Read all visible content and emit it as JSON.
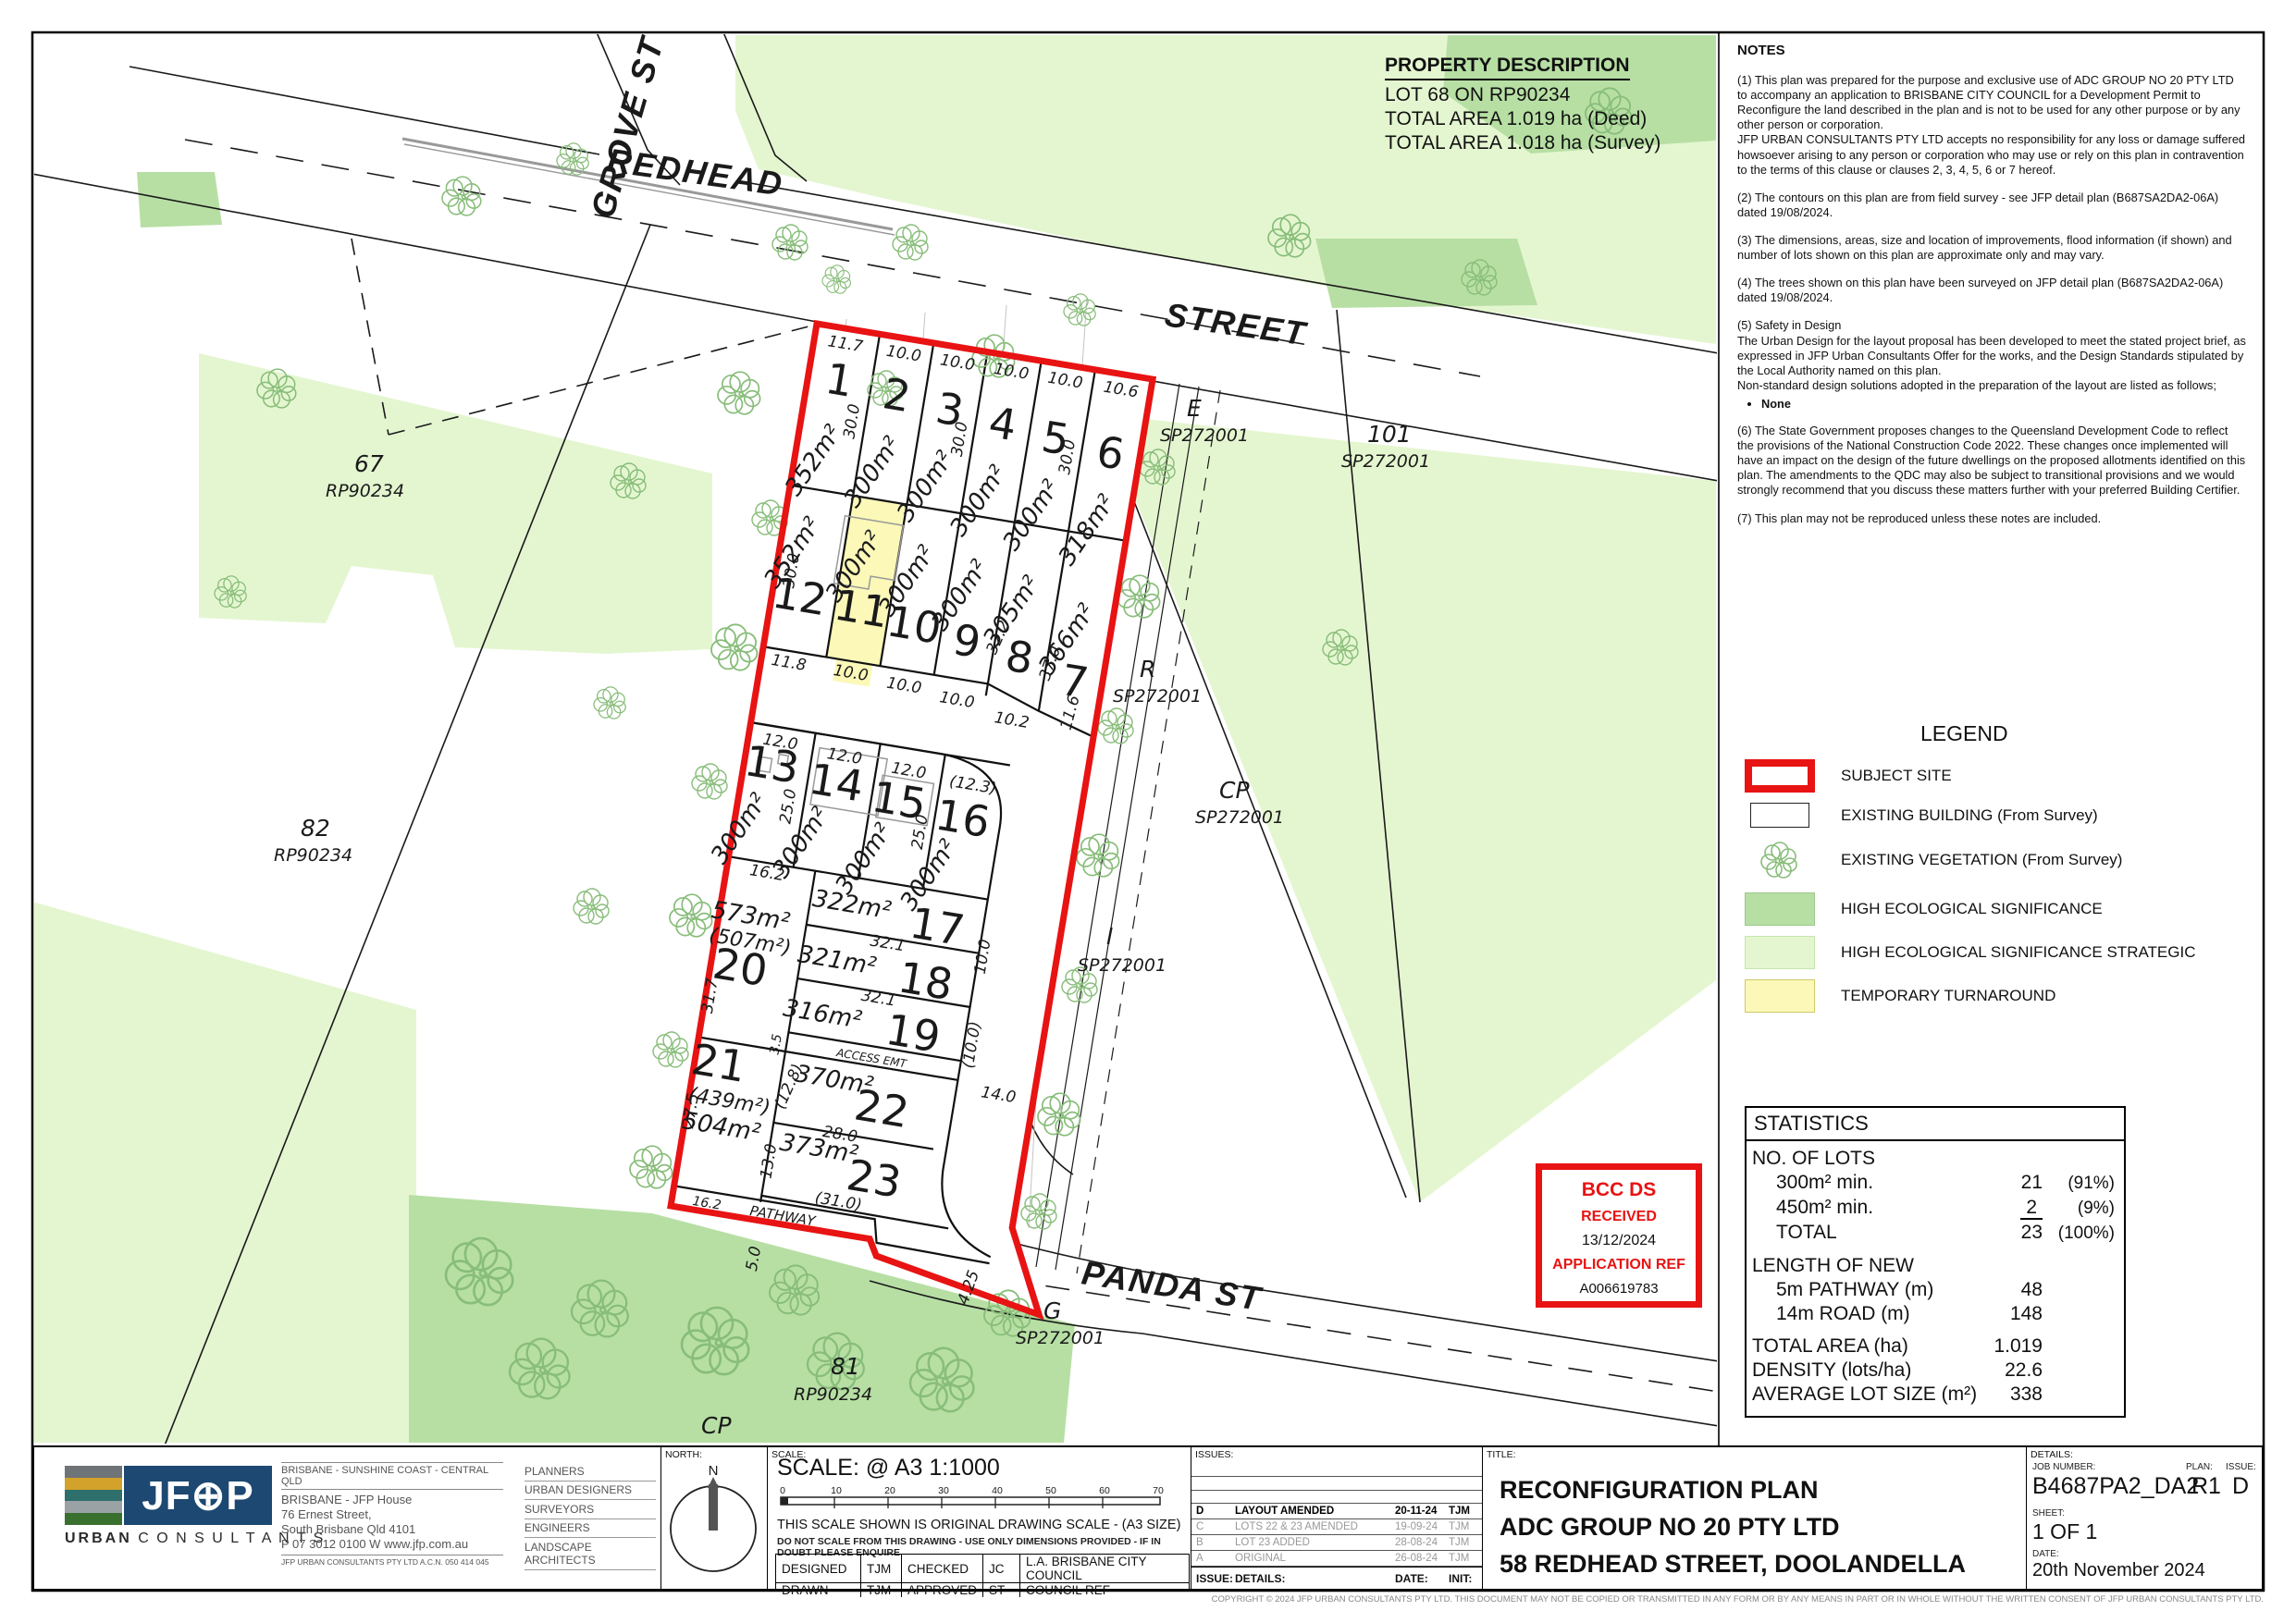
{
  "colors": {
    "red": "#e81313",
    "hes": "#b7dfa4",
    "hes_strategic": "#e4f6d0",
    "turnaround": "#fbf8b8",
    "navy": "#1d4872"
  },
  "property": {
    "title": "PROPERTY DESCRIPTION",
    "line1": "LOT 68 ON RP90234",
    "line2": "TOTAL AREA  1.019 ha (Deed)",
    "line3": "TOTAL AREA  1.018 ha (Survey)"
  },
  "notes": {
    "title": "NOTES",
    "n1": "(1) This plan was prepared for the purpose and exclusive use of ADC GROUP NO 20 PTY LTD to accompany an application to BRISBANE CITY COUNCIL for a Development Permit to Reconfigure the land described in the plan and is not to be used for any other purpose or by any other person or corporation.\nJFP URBAN CONSULTANTS PTY LTD accepts no responsibility for any loss or damage suffered howsoever arising to any person or corporation who may use or rely on this plan in contravention to the terms of this clause or clauses 2, 3, 4, 5, 6 or 7 hereof.",
    "n2": "(2) The contours on this plan are from field survey - see JFP detail plan (B687SA2DA2-06A) dated 19/08/2024.",
    "n3": "(3) The dimensions, areas, size and location of improvements, flood information (if shown) and number of lots shown on this plan are approximate only and may vary.",
    "n4": "(4) The trees shown on this plan have been surveyed on JFP detail plan (B687SA2DA2-06A) dated 19/08/2024.",
    "n5": "(5) Safety in Design\nThe Urban Design for the layout proposal has been developed to meet the stated project brief, as expressed in JFP Urban Consultants Offer for the works, and the Design Standards stipulated by the Local Authority named on this plan.\nNon-standard design solutions adopted in the preparation of the layout are listed as follows;",
    "n5_bullet": "None",
    "n6": "(6) The State Government proposes changes to the Queensland Development Code to reflect the provisions of the National Construction Code 2022. These changes once implemented will have an impact on the design of the future dwellings on the proposed allotments identified on this plan. The amendments to the QDC may also be subject to transitional provisions and we would strongly recommend that you discuss these matters further with your preferred Building Certifier.",
    "n7": "(7) This plan may not be reproduced unless these notes are included."
  },
  "legend": {
    "title": "LEGEND",
    "subject": "SUBJECT SITE",
    "building": "EXISTING BUILDING (From Survey)",
    "vegetation": "EXISTING VEGETATION (From Survey)",
    "hes": "HIGH ECOLOGICAL SIGNIFICANCE",
    "hes_strategic": "HIGH ECOLOGICAL SIGNIFICANCE STRATEGIC",
    "turnaround": "TEMPORARY TURNAROUND"
  },
  "stamp": {
    "line1": "BCC DS",
    "line2": "RECEIVED",
    "date": "13/12/2024",
    "line3": "APPLICATION REF",
    "ref": "A006619783"
  },
  "stats": {
    "title": "STATISTICS",
    "no_of_lots": "NO. OF LOTS",
    "r300_label": "300m² min.",
    "r300_val": "21",
    "r300_pct": "(91%)",
    "r450_label": "450m² min.",
    "r450_val": "2",
    "r450_pct": "(9%)",
    "total_label": "TOTAL",
    "total_val": "23",
    "total_pct": "(100%)",
    "length_label": "LENGTH OF NEW",
    "pathway_label": "5m PATHWAY (m)",
    "pathway_val": "48",
    "road_label": "14m ROAD (m)",
    "road_val": "148",
    "area_label": "TOTAL AREA (ha)",
    "area_val": "1.019",
    "density_label": "DENSITY (lots/ha)",
    "density_val": "22.6",
    "avg_label": "AVERAGE LOT SIZE (m²)",
    "avg_val": "338"
  },
  "titleblock": {
    "headers": {
      "north": "NORTH:",
      "scale": "SCALE:",
      "issues": "ISSUES:",
      "title": "TITLE:",
      "details": "DETAILS:"
    },
    "company": {
      "logo": "JF⊕P",
      "urban": "URBAN",
      "consultants": "C O N S U L T A N T S",
      "region": "BRISBANE - SUNSHINE COAST - CENTRAL QLD",
      "office": "BRISBANE - JFP House",
      "street": "76 Ernest Street,",
      "city": "South Brisbane Qld 4101",
      "phone": "P 07 3012 0100   W www.jfp.com.au",
      "acn": "JFP URBAN CONSULTANTS PTY LTD  A.C.N. 050 414 045"
    },
    "services": [
      "PLANNERS",
      "URBAN DESIGNERS",
      "SURVEYORS",
      "ENGINEERS",
      "LANDSCAPE ARCHITECTS"
    ],
    "north_n": "N",
    "scale": {
      "label": "SCALE: @ A3  1:1000",
      "ticks": [
        "0",
        "10",
        "20",
        "30",
        "40",
        "50",
        "60",
        "70"
      ],
      "note1": "THIS SCALE SHOWN IS ORIGINAL DRAWING SCALE - (A3 SIZE)",
      "note2": "DO NOT SCALE FROM THIS DRAWING - USE ONLY DIMENSIONS PROVIDED - IF IN DOUBT PLEASE ENQUIRE"
    },
    "credits": {
      "designed_label": "DESIGNED",
      "designed": "TJM",
      "checked_label": "CHECKED",
      "checked": "JC",
      "la": "L.A.   BRISBANE CITY COUNCIL",
      "drawn_label": "DRAWN",
      "drawn": "TJM",
      "approved_label": "APPROVED",
      "approved": "ST",
      "council_ref": "COUNCIL REF"
    },
    "issues": {
      "rows": [
        {
          "issue": "D",
          "details": "LAYOUT AMENDED",
          "date": "20-11-24",
          "init": "TJM"
        },
        {
          "issue": "C",
          "details": "LOTS 22 & 23 AMENDED",
          "date": "19-09-24",
          "init": "TJM"
        },
        {
          "issue": "B",
          "details": "LOT 23 ADDED",
          "date": "28-08-24",
          "init": "TJM"
        },
        {
          "issue": "A",
          "details": "ORIGINAL",
          "date": "26-08-24",
          "init": "TJM"
        }
      ],
      "foot": {
        "issue": "ISSUE:",
        "details": "DETAILS:",
        "date": "DATE:",
        "init": "INIT:"
      }
    },
    "title": {
      "line1": "RECONFIGURATION PLAN",
      "line2": "ADC GROUP NO 20 PTY LTD",
      "line3": "58 REDHEAD STREET, DOOLANDELLA"
    },
    "details": {
      "job_label": "JOB NUMBER:",
      "plan_label": "PLAN:",
      "issue_label": "ISSUE:",
      "job": "B4687PA2_DA2",
      "plan": "R1",
      "issue": "D",
      "sheet_label": "SHEET:",
      "sheet": "1 OF 1",
      "date_label": "DATE:",
      "date": "20th November 2024"
    },
    "copyright": "COPYRIGHT © 2024 JFP URBAN CONSULTANTS PTY LTD.  THIS DOCUMENT MAY NOT BE COPIED OR TRANSMITTED IN ANY FORM OR BY ANY MEANS IN PART OR IN WHOLE WITHOUT THE WRITTEN CONSENT OF JFP URBAN CONSULTANTS PTY LTD."
  },
  "map": {
    "streets": {
      "redhead": "REDHEAD",
      "street": "STREET",
      "grove": "GROVE ST",
      "panda": "PANDA   ST"
    },
    "labels": {
      "pathway": "PATHWAY",
      "access": "ACCESS  EMT"
    },
    "lots": [
      {
        "no": "1",
        "area": "352m²"
      },
      {
        "no": "2",
        "area": "300m²"
      },
      {
        "no": "3",
        "area": "300m²"
      },
      {
        "no": "4",
        "area": "300m²"
      },
      {
        "no": "5",
        "area": "300m²"
      },
      {
        "no": "6",
        "area": "318m²"
      },
      {
        "no": "7",
        "area": "366m²"
      },
      {
        "no": "8",
        "area": "305m²"
      },
      {
        "no": "9",
        "area": "300m²"
      },
      {
        "no": "10",
        "area": "300m²"
      },
      {
        "no": "11",
        "area": "300m²"
      },
      {
        "no": "12",
        "area": "352m²"
      },
      {
        "no": "13",
        "area": "300m²"
      },
      {
        "no": "14",
        "area": "300m²"
      },
      {
        "no": "15",
        "area": "300m²"
      },
      {
        "no": "16",
        "area": "300m²"
      },
      {
        "no": "17",
        "area": "322m²"
      },
      {
        "no": "18",
        "area": "321m²"
      },
      {
        "no": "19",
        "area": "316m²"
      },
      {
        "no": "20",
        "area": "573m²",
        "area2": "(507m²)"
      },
      {
        "no": "21",
        "area": "504m²",
        "area2": "(439m²)"
      },
      {
        "no": "22",
        "area": "370m²"
      },
      {
        "no": "23",
        "area": "373m²"
      }
    ],
    "parcels": {
      "p67": "67",
      "p67_plan": "RP90234",
      "p82": "82",
      "p82_plan": "RP90234",
      "p81": "81",
      "p81_plan": "RP90234",
      "p101": "101",
      "p101_plan": "SP272001",
      "pE": "E",
      "pE_plan": "SP272001",
      "pR": "R",
      "pR_plan": "SP272001",
      "pCP": "CP",
      "pCP_plan": "SP272001",
      "pI": "I",
      "pI_plan": "SP272001",
      "pG": "G",
      "pG_plan": "SP272001",
      "pCP2": "CP"
    },
    "dims": [
      "11.7",
      "10.0",
      "10.0",
      "10.0",
      "10.0",
      "10.6",
      "30.0",
      "30.0",
      "30.0",
      "11.8",
      "10.0",
      "10.0",
      "10.0",
      "10.2",
      "30.0",
      "32.2",
      "37.0",
      "11.6",
      "12.0",
      "12.0",
      "12.0",
      "(12.3)",
      "25.0",
      "25.0",
      "16.2",
      "31.7",
      "32.1",
      "32.1",
      "3.5",
      "10.0",
      "(10.0)",
      "14.0",
      "27.5",
      "(12.8)",
      "13.0",
      "28.0",
      "(31.0)",
      "16.2",
      "5.0",
      "4.25"
    ]
  }
}
